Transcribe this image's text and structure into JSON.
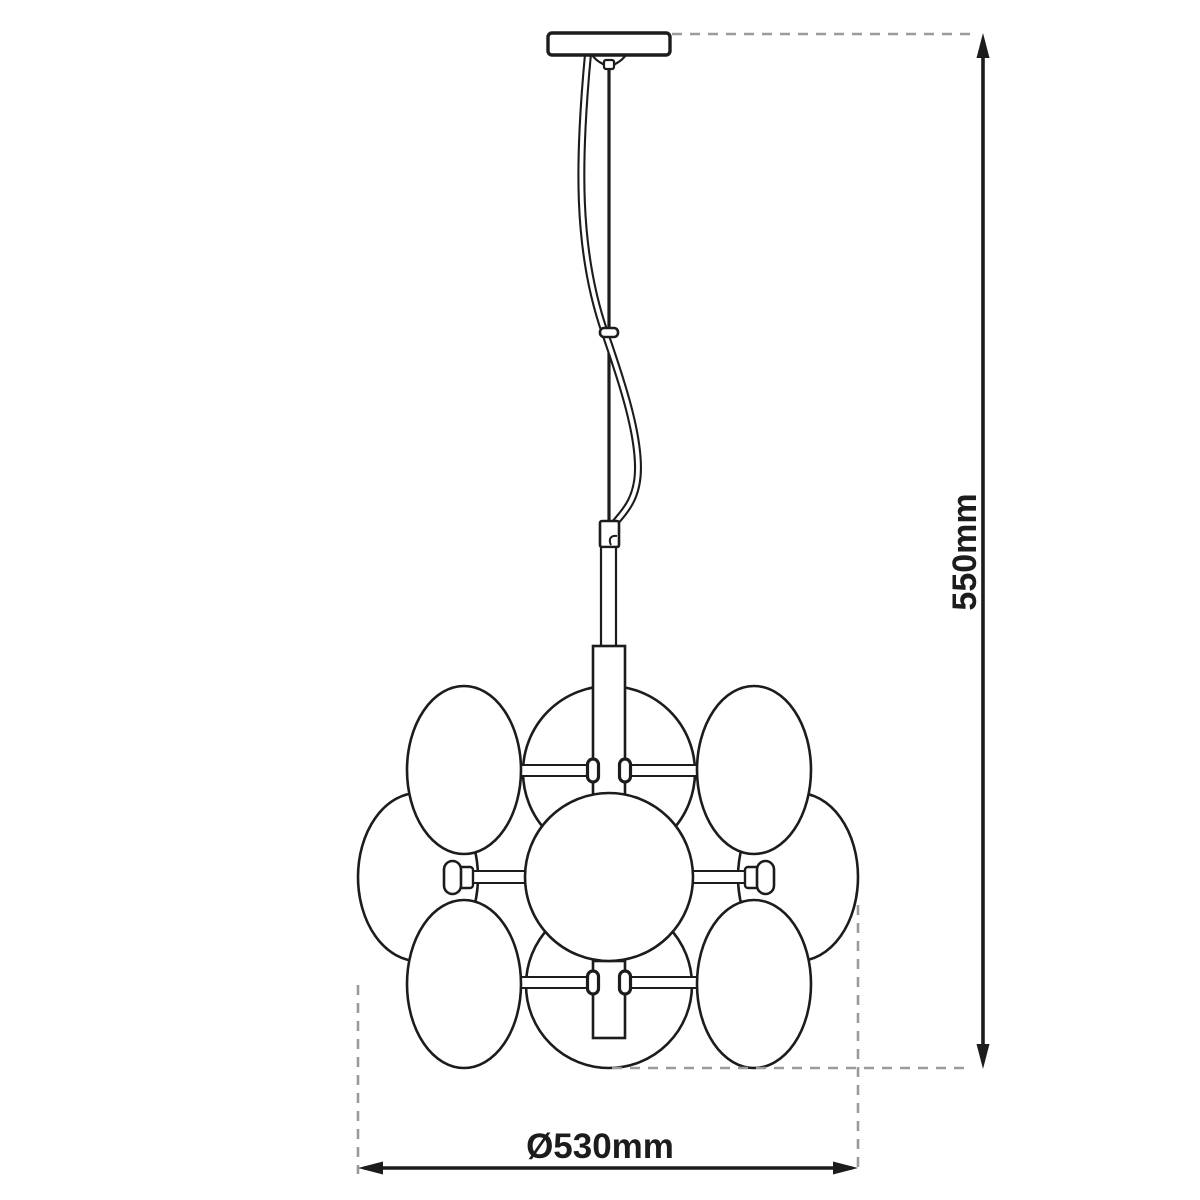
{
  "diagram": {
    "kind": "pendant-lamp-dimension-drawing",
    "globe_count": 9,
    "dimensions": {
      "height_label": "550mm",
      "diameter_label": "Ø530mm"
    },
    "colors": {
      "line": "#1c1c1c",
      "extension_line": "#9b9b9b",
      "background": "#ffffff",
      "text": "#1c1c1c"
    }
  }
}
